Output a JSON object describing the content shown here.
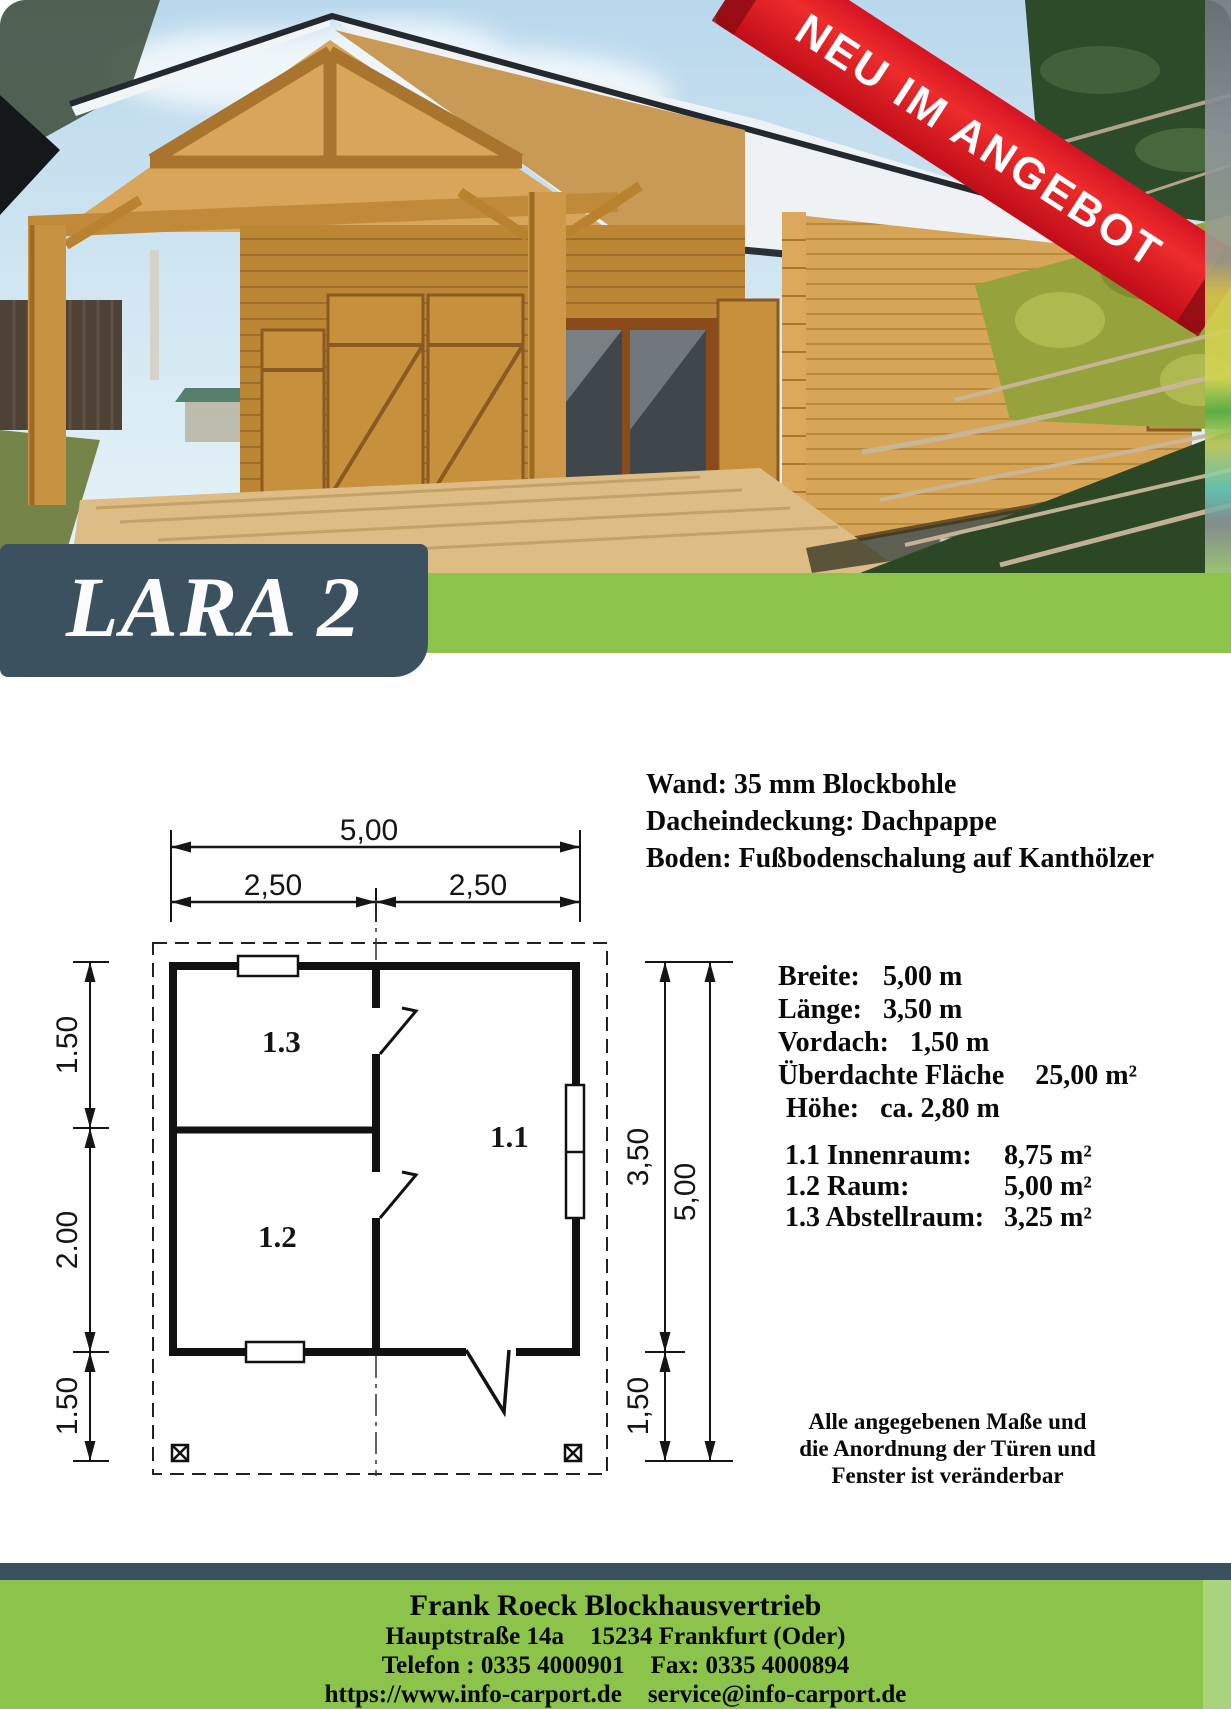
{
  "ribbon": {
    "label": "NEU IM ANGEBOT",
    "color": "#d41423"
  },
  "title": {
    "label": "LARA 2"
  },
  "specs": {
    "lines": [
      "Wand: 35 mm Blockbohle",
      "Dacheindeckung: Dachpappe",
      "Boden: Fußbodenschalung auf Kanthölzer"
    ]
  },
  "building": {
    "rows": [
      {
        "label": "Breite:",
        "value": "5,00 m"
      },
      {
        "label": "Länge:",
        "value": "3,50 m"
      },
      {
        "label": "Vordach:",
        "value": "1,50 m"
      },
      {
        "label": "Überdachte Fläche",
        "value": "25,00 m²"
      },
      {
        "label": "Höhe:",
        "value": "ca. 2,80 m"
      }
    ]
  },
  "rooms": {
    "rows": [
      {
        "label": "1.1 Innenraum:",
        "value": "8,75 m²"
      },
      {
        "label": "1.2 Raum:",
        "value": "5,00 m²"
      },
      {
        "label": "1.3 Abstellraum:",
        "value": "3,25 m²"
      }
    ]
  },
  "note": {
    "lines": [
      "Alle angegebenen Maße und",
      "die Anordnung der Türen und",
      "Fenster ist veränderbar"
    ]
  },
  "floorplan": {
    "top_total": "5,00",
    "top_left": "2,50",
    "top_right": "2,50",
    "left_top": "1.50",
    "left_mid": "2.00",
    "left_bottom": "1.50",
    "right_inner": "3,50",
    "right_outer": "5,00",
    "right_bottom": "1,50",
    "room_11": "1.1",
    "room_12": "1.2",
    "room_13": "1.3"
  },
  "footer": {
    "company": "Frank Roeck Blockhausvertrieb",
    "address_1": "Hauptstraße 14a",
    "address_2": "15234 Frankfurt (Oder)",
    "phone": "Telefon : 0335 4000901",
    "fax": "Fax: 0335 4000894",
    "web": "https://www.info-carport.de",
    "email": "service@info-carport.de"
  },
  "colors": {
    "slate": "#3b5160",
    "green": "#8cc44b",
    "ribbon_red": "#d41423"
  }
}
